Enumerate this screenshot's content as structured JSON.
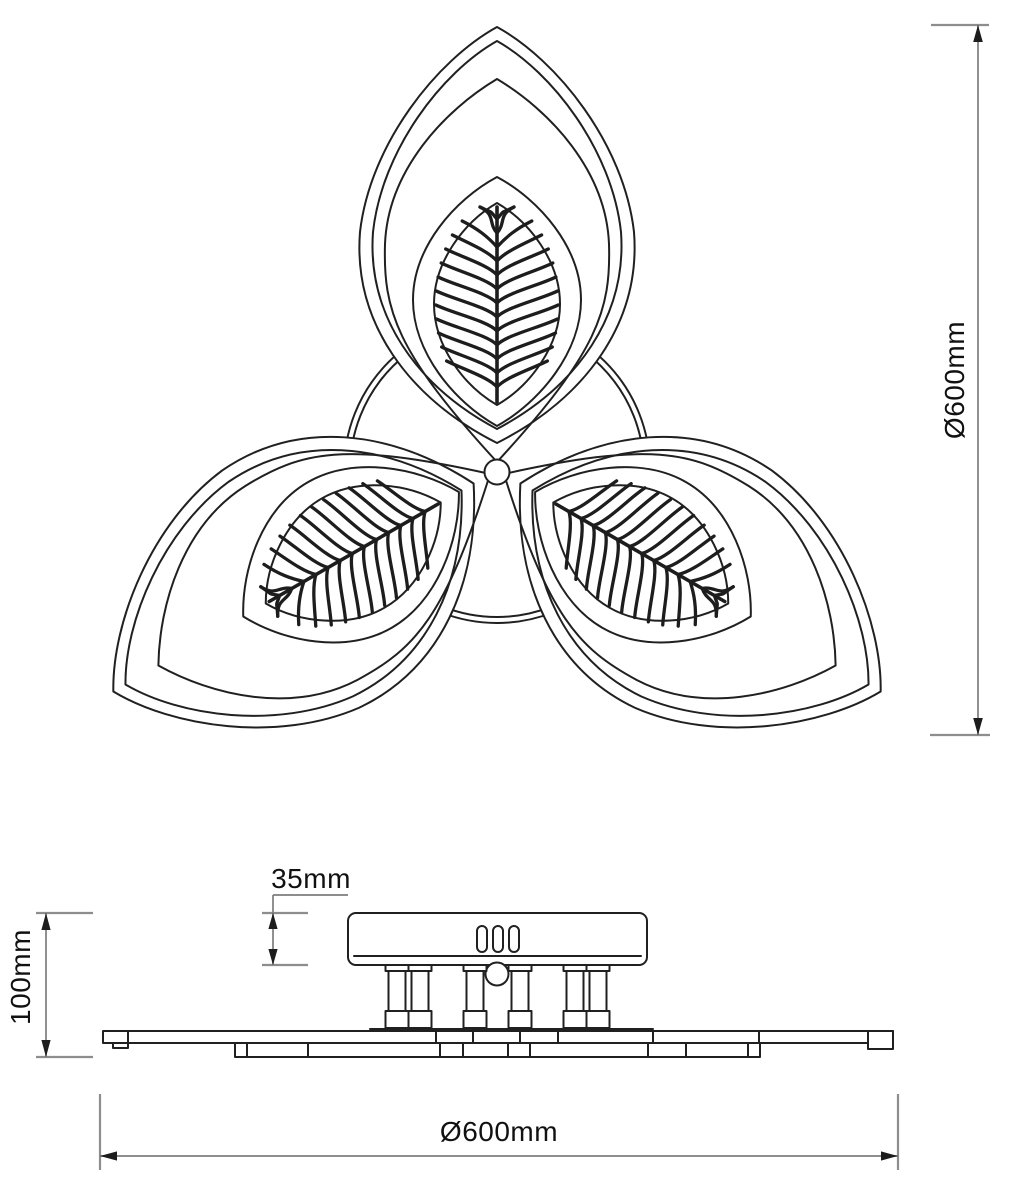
{
  "drawing": {
    "background": "#ffffff",
    "line_color": "#202020",
    "dimension_line_color": "#7d7d7d",
    "text_color": "#111111",
    "top_view": {
      "arm_count": 3,
      "diameter_label": "Ø600mm"
    },
    "side_view": {
      "overall_height_label": "100mm",
      "canopy_height_label": "35mm",
      "overall_width_label": "Ø600mm"
    }
  }
}
